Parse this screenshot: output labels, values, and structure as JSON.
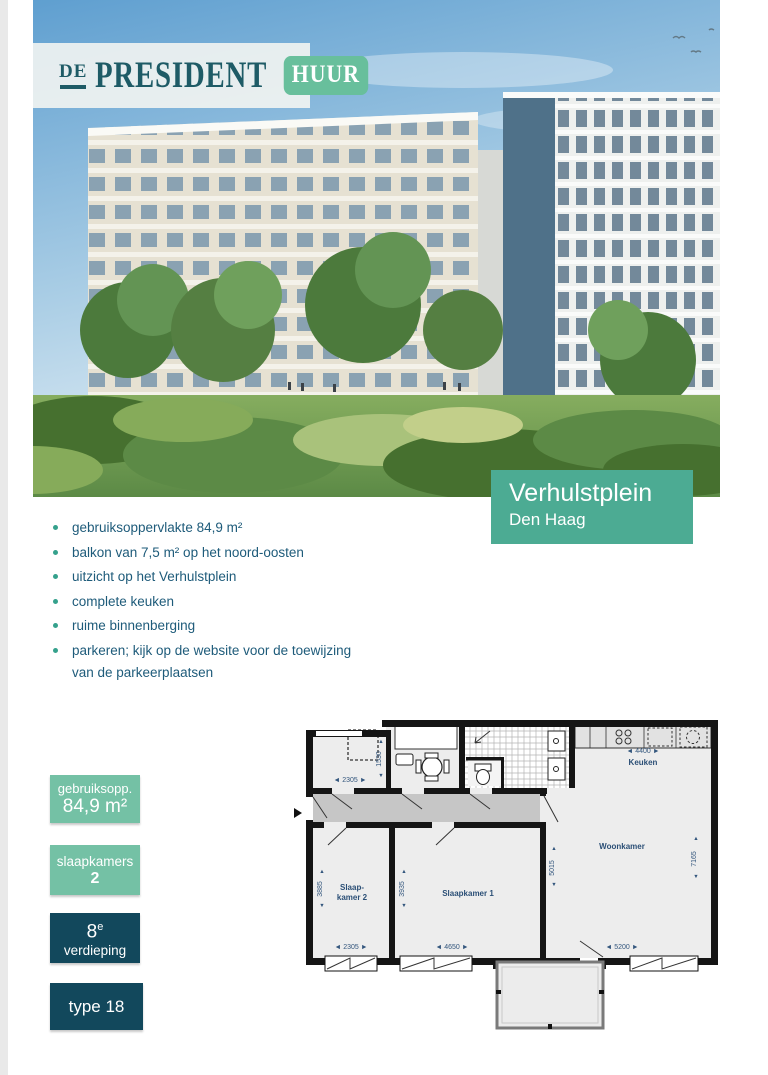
{
  "logo": {
    "prefix": "DE",
    "title": "PRESIDENT",
    "badge": "HUUR"
  },
  "location": {
    "name": "Verhulstplein",
    "city": "Den Haag"
  },
  "features": {
    "items": [
      "gebruiksoppervlakte 84,9 m²",
      "balkon van 7,5 m² op het noord-oosten",
      "uitzicht op het Verhulstplein",
      "complete keuken",
      "ruime binnenberging",
      "parkeren; kijk op de website voor de toewijzing van de parkeerplaatsen"
    ]
  },
  "stat_boxes": {
    "area": {
      "label": "gebruiksopp.",
      "value": "84,9 m²"
    },
    "bedrooms": {
      "label": "slaapkamers",
      "value": "2"
    },
    "floor": {
      "number": "8",
      "suffix": "e",
      "label": "verdieping"
    },
    "type": {
      "value": "type 18"
    }
  },
  "floorplan": {
    "labels": {
      "kitchen": "Keuken",
      "living": "Woonkamer",
      "bedroom1": "Slaapkamer 1",
      "bedroom2a": "Slaap-",
      "bedroom2b": "kamer 2"
    },
    "dims_h": {
      "kitchen": "◄ 4400 ►",
      "storage": "◄ 2305 ►",
      "bedroom2": "◄ 2305 ►",
      "bedroom1": "◄ 4650 ►",
      "living": "◄ 5200 ►"
    },
    "dims_v": {
      "storage": "1530",
      "bedroom2": "3885",
      "bedroom1": "3935",
      "living_inner": "5015",
      "living_outer": "7165"
    },
    "arrow_up": "▲",
    "arrow_down": "▼"
  },
  "colors": {
    "accent_green": "#74c1a5",
    "location_teal": "#4cab93",
    "dark_teal": "#12485c",
    "text_navy": "#1e5b7a",
    "logo_teal": "#1e5b66",
    "badge_green": "#68bf9c"
  }
}
